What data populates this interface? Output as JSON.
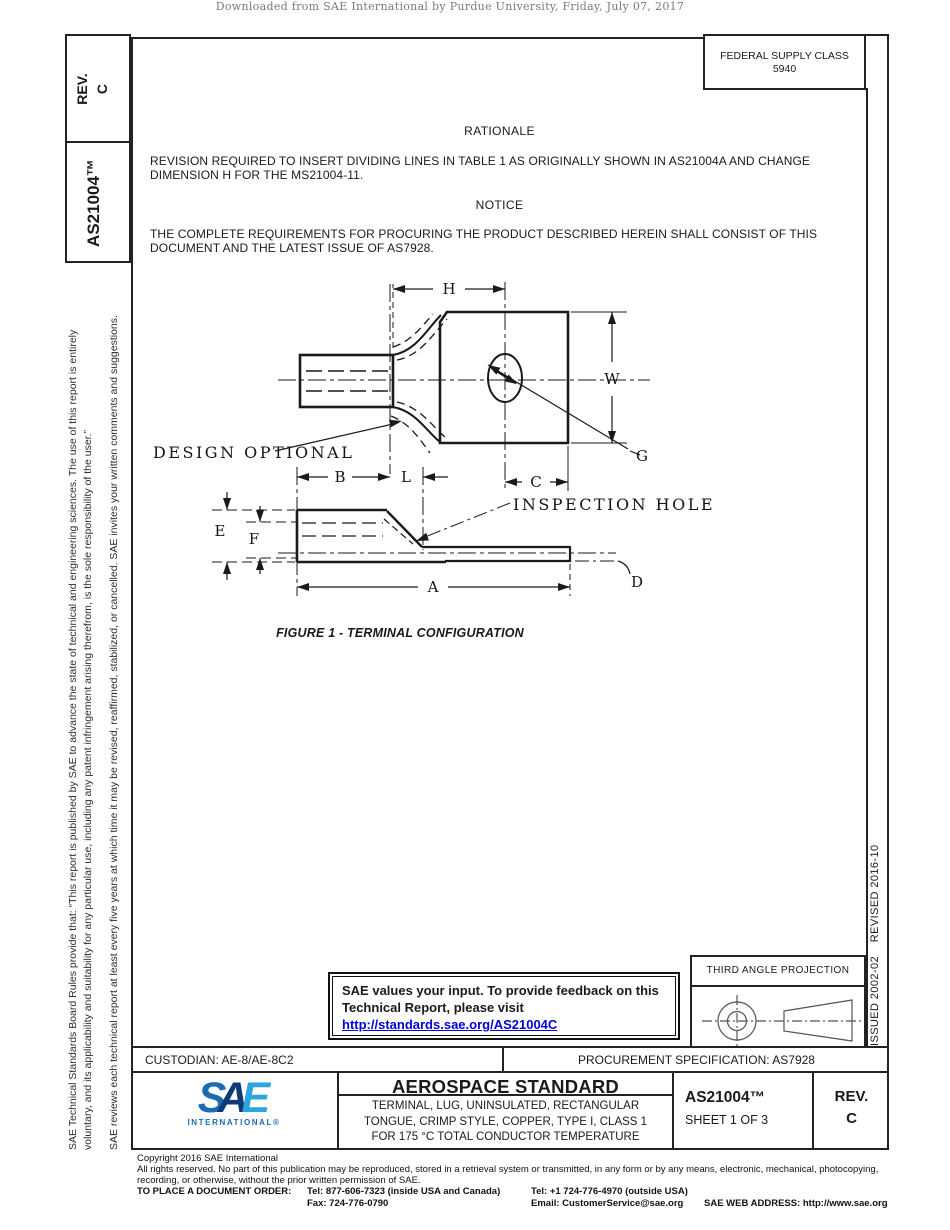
{
  "page": {
    "download_notice": "Downloaded from SAE International by Purdue University, Friday, July 07, 2017"
  },
  "sidebar_left": {
    "rev_label": "REV.",
    "rev_value": "C",
    "doc_number": "AS21004™",
    "disclaimer_para1_line1": "SAE Technical Standards Board Rules provide that: “This report is published by SAE to advance the state of technical and engineering sciences. The use of this report is entirely",
    "disclaimer_para1_line2": "voluntary, and its applicability and suitability for any particular use, including any patent infringement arising therefrom, is the sole responsibility of the user.”",
    "disclaimer_para2": "SAE reviews each technical report at least every five years at which time it may be revised, reaffirmed, stabilized, or cancelled. SAE invites your written comments and suggestions."
  },
  "sidebar_right": {
    "issued_revised": "ISSUED 2002-02    REVISED 2016-10"
  },
  "fsc_box": {
    "line1": "FEDERAL SUPPLY CLASS",
    "line2": "5940"
  },
  "rationale": {
    "heading": "RATIONALE",
    "line1": "REVISION REQUIRED TO INSERT DIVIDING LINES IN TABLE 1 AS ORIGINALLY SHOWN IN AS21004A AND CHANGE",
    "line2": "DIMENSION H FOR THE MS21004-11."
  },
  "notice": {
    "heading": "NOTICE",
    "line1": "THE COMPLETE REQUIREMENTS FOR PROCURING THE PRODUCT DESCRIBED HEREIN SHALL CONSIST OF THIS",
    "line2": "DOCUMENT AND THE LATEST ISSUE OF AS7928."
  },
  "figure": {
    "caption": "FIGURE 1 - TERMINAL CONFIGURATION",
    "labels": {
      "h": "H",
      "w": "W",
      "g": "G",
      "c": "C",
      "b": "B",
      "l": "L",
      "e": "E",
      "f": "F",
      "a": "A",
      "d": "D",
      "design_optional": "DESIGN OPTIONAL",
      "inspection_hole": "INSPECTION HOLE"
    }
  },
  "feedback_box": {
    "line1": "SAE values your input. To provide feedback on this",
    "line2": "Technical Report, please visit",
    "link": "http://standards.sae.org/AS21004C"
  },
  "projection_box": {
    "title": "THIRD ANGLE PROJECTION"
  },
  "info_row": {
    "custodian": "CUSTODIAN: AE-8/AE-8C2",
    "procurement": "PROCUREMENT SPECIFICATION: AS7928"
  },
  "title_block": {
    "logo_s": "S",
    "logo_a": "A",
    "logo_e": "E",
    "logo_sub": "INTERNATIONAL®",
    "title": "AEROSPACE STANDARD",
    "subtitle_line1": "TERMINAL, LUG, UNINSULATED, RECTANGULAR",
    "subtitle_line2": "TONGUE, CRIMP STYLE, COPPER, TYPE I, CLASS 1",
    "subtitle_line3": "FOR 175 °C TOTAL CONDUCTOR TEMPERATURE",
    "doc_number": "AS21004™",
    "sheet": "SHEET 1 OF 3",
    "rev_label": "REV.",
    "rev_value": "C"
  },
  "footer": {
    "copyright": "Copyright 2016 SAE International",
    "rights_line1": "All rights reserved. No part of this publication may be reproduced, stored in a retrieval system or transmitted, in any form or by any means, electronic, mechanical, photocopying,",
    "rights_line2": "recording, or otherwise, without the prior written permission of SAE.",
    "order_label": "TO PLACE A DOCUMENT ORDER:",
    "tel_inside": "Tel: 877-606-7323 (inside USA and Canada)",
    "tel_outside": "Tel: +1 724-776-4970 (outside USA)",
    "fax": "Fax: 724-776-0790",
    "email": "Email: CustomerService@sae.org",
    "web": "SAE WEB ADDRESS: http://www.sae.org"
  },
  "colors": {
    "link_blue": "#0000dd",
    "logo_blue": "#1b6cb0",
    "logo_navy": "#0e3b77",
    "logo_light_blue": "#2ba5e0"
  }
}
